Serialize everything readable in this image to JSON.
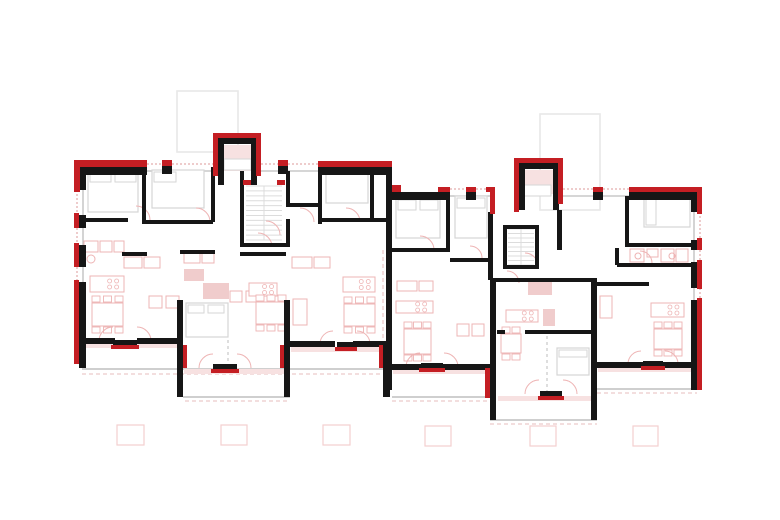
{
  "document": {
    "kind": "architectural-floor-plan",
    "description": "Upper floor plan of two adjoined residential blocks with red-highlighted exterior insulation, entrance vestibules, stair cores and balconies"
  },
  "canvas": {
    "w": 780,
    "h": 520,
    "bg": "#ffffff"
  },
  "palette": {
    "wall_black": "#161616",
    "accent_red": "#c41e23",
    "furniture_pink": "#eeb4b4",
    "fixture_fill": "#f0cccc",
    "band_fill": "#f7e1e1",
    "bed_gray": "#d6d6d6",
    "stair_gray": "#dcdcdc",
    "window_gray": "#bdbdbd",
    "window_red": "#dd9a9a",
    "slab_gray": "#cfcfcf",
    "dash_pink": "#e7bcbc",
    "dash_gray": "#c9c9c9",
    "roof_gray": "#e8e8e8",
    "planter_pink": "#f3cfcf"
  },
  "plan": {
    "roofs": [
      [
        177,
        91,
        61,
        61
      ],
      [
        540,
        114,
        60,
        96
      ]
    ],
    "slab_lines": [
      [
        82,
        369,
        390,
        369
      ],
      [
        183,
        397,
        290,
        397
      ],
      [
        392,
        397,
        490,
        397
      ],
      [
        490,
        420,
        597,
        420
      ],
      [
        597,
        389,
        697,
        389
      ]
    ],
    "pink_dash": [
      [
        82,
        374,
        390,
        374
      ],
      [
        185,
        401,
        288,
        401
      ],
      [
        392,
        401,
        490,
        401
      ],
      [
        490,
        424,
        597,
        424
      ],
      [
        597,
        393,
        697,
        393
      ],
      [
        383,
        250,
        383,
        338
      ]
    ],
    "gray_dash": [
      [
        228,
        340,
        228,
        366
      ],
      [
        547,
        336,
        547,
        393
      ]
    ],
    "light_bands": [
      [
        84,
        343,
        93,
        5
      ],
      [
        291,
        347,
        92,
        5
      ],
      [
        184,
        369,
        100,
        5
      ],
      [
        393,
        369,
        97,
        5
      ],
      [
        598,
        367,
        93,
        5
      ],
      [
        498,
        396,
        93,
        5
      ],
      [
        220,
        145,
        31,
        26
      ],
      [
        521,
        170,
        32,
        24
      ]
    ],
    "pink_fills": [
      [
        203,
        283,
        26,
        16
      ],
      [
        528,
        282,
        24,
        13
      ],
      [
        543,
        309,
        12,
        17
      ],
      [
        184,
        269,
        20,
        12
      ]
    ],
    "window_gray": [
      [
        147,
        171,
        162,
        171
      ],
      [
        172,
        171,
        213,
        171
      ],
      [
        261,
        171,
        278,
        171
      ],
      [
        288,
        171,
        318,
        171
      ],
      [
        83,
        190,
        83,
        215
      ],
      [
        83,
        228,
        83,
        245
      ],
      [
        83,
        267,
        83,
        282
      ],
      [
        450,
        196,
        466,
        196
      ],
      [
        476,
        196,
        490,
        196
      ],
      [
        563,
        196,
        593,
        196
      ],
      [
        603,
        196,
        629,
        196
      ],
      [
        694,
        212,
        694,
        240
      ],
      [
        694,
        250,
        694,
        262
      ],
      [
        694,
        288,
        694,
        300
      ]
    ],
    "window_red_dash": [
      [
        147,
        164,
        162,
        164
      ],
      [
        172,
        164,
        213,
        164
      ],
      [
        261,
        164,
        278,
        164
      ],
      [
        288,
        164,
        318,
        164
      ],
      [
        77,
        190,
        77,
        215
      ],
      [
        77,
        228,
        77,
        245
      ],
      [
        77,
        267,
        77,
        282
      ],
      [
        450,
        189,
        466,
        189
      ],
      [
        476,
        189,
        490,
        189
      ],
      [
        563,
        189,
        593,
        189
      ],
      [
        603,
        189,
        629,
        189
      ],
      [
        700,
        212,
        700,
        240
      ],
      [
        700,
        250,
        700,
        262
      ],
      [
        700,
        288,
        700,
        300
      ]
    ],
    "furniture": [
      [
        124,
        257,
        18,
        11
      ],
      [
        144,
        257,
        16,
        11
      ],
      [
        292,
        257,
        20,
        11
      ],
      [
        314,
        257,
        16,
        11
      ],
      [
        397,
        281,
        20,
        10
      ],
      [
        419,
        281,
        14,
        10
      ],
      [
        630,
        249,
        14,
        13
      ],
      [
        647,
        249,
        11,
        8
      ],
      [
        661,
        249,
        13,
        13
      ],
      [
        676,
        249,
        12,
        13
      ],
      [
        184,
        253,
        16,
        10
      ],
      [
        202,
        253,
        12,
        10
      ],
      [
        84,
        241,
        14,
        11
      ],
      [
        100,
        241,
        12,
        11
      ],
      [
        114,
        241,
        10,
        11
      ],
      [
        149,
        296,
        13,
        12
      ],
      [
        166,
        296,
        13,
        12
      ],
      [
        230,
        291,
        12,
        11
      ],
      [
        246,
        291,
        12,
        11
      ],
      [
        457,
        324,
        12,
        12
      ],
      [
        472,
        324,
        12,
        12
      ],
      [
        293,
        299,
        14,
        26
      ],
      [
        600,
        296,
        12,
        22
      ]
    ],
    "islands": [
      [
        90,
        276,
        34,
        16
      ],
      [
        249,
        283,
        28,
        13
      ],
      [
        343,
        277,
        32,
        15
      ],
      [
        396,
        301,
        37,
        12
      ],
      [
        506,
        310,
        32,
        12
      ],
      [
        651,
        303,
        33,
        14
      ]
    ],
    "tables": [
      [
        92,
        303,
        31,
        23,
        6
      ],
      [
        256,
        302,
        30,
        22,
        6
      ],
      [
        344,
        304,
        31,
        22,
        6
      ],
      [
        404,
        329,
        27,
        25,
        6
      ],
      [
        501,
        334,
        20,
        19,
        4
      ],
      [
        654,
        329,
        28,
        20,
        6
      ]
    ],
    "beds": [
      [
        88,
        170,
        50,
        42
      ],
      [
        152,
        170,
        52,
        38
      ],
      [
        326,
        171,
        42,
        32
      ],
      [
        396,
        198,
        44,
        40
      ],
      [
        455,
        196,
        32,
        42
      ],
      [
        644,
        197,
        46,
        30
      ],
      [
        186,
        303,
        42,
        34
      ],
      [
        557,
        348,
        32,
        27
      ]
    ],
    "gray_rects": [
      [
        224,
        159,
        27,
        11
      ],
      [
        523,
        185,
        28,
        11
      ],
      [
        90,
        172,
        21,
        10
      ],
      [
        115,
        172,
        21,
        10
      ],
      [
        154,
        172,
        22,
        10
      ],
      [
        398,
        200,
        18,
        10
      ],
      [
        420,
        200,
        18,
        10
      ],
      [
        646,
        199,
        10,
        26
      ],
      [
        457,
        198,
        28,
        10
      ],
      [
        188,
        305,
        16,
        8
      ],
      [
        208,
        305,
        16,
        8
      ],
      [
        559,
        350,
        28,
        7
      ]
    ],
    "circles": [
      [
        91,
        259,
        4
      ],
      [
        638,
        256,
        3
      ],
      [
        672,
        256,
        3
      ]
    ],
    "stairs": [
      [
        246,
        186,
        36,
        54,
        11
      ],
      [
        508,
        229,
        26,
        36,
        8
      ]
    ],
    "arcs": [
      "M 99,341 A 14 14 0 0 1 113,327",
      "M 137,327 A 14 14 0 0 1 151,341",
      "M 199,368 A 14 14 0 0 1 213,354",
      "M 237,354 A 14 14 0 0 1 251,368",
      "M 320,344 A 13 13 0 0 1 333,331",
      "M 357,331 A 13 13 0 0 1 370,344",
      "M 406,367 A 14 14 0 0 1 420,353",
      "M 444,353 A 14 14 0 0 1 458,367",
      "M 525,394 A 14 14 0 0 1 539,380",
      "M 563,380 A 14 14 0 0 1 577,394",
      "M 628,364 A 13 13 0 0 1 641,351",
      "M 665,351 A 13 13 0 0 1 678,364",
      "M 136,206 A 14 14 0 0 1 150,220",
      "M 196,208 A 14 14 0 0 1 210,222",
      "M 258,233 A 14 14 0 0 1 272,247",
      "M 300,208 A 14 14 0 0 1 314,222",
      "M 346,208 A 14 14 0 0 1 360,222",
      "M 420,236 A 14 14 0 0 1 434,250",
      "M 470,246 A 12 12 0 0 1 482,258",
      "M 525,253 A 13 13 0 0 1 538,266",
      "M 640,251 A 12 12 0 0 1 652,263",
      "M 507,271 A 12 12 0 0 1 519,283",
      "M 266,221 A 14 14 0 0 1 280,235"
    ],
    "walls_black": [
      [
        80,
        167,
        67,
        8
      ],
      [
        79,
        163,
        7,
        27
      ],
      [
        162,
        166,
        10,
        8
      ],
      [
        278,
        166,
        10,
        8
      ],
      [
        318,
        167,
        74,
        8
      ],
      [
        386,
        163,
        6,
        227
      ],
      [
        79,
        215,
        7,
        13
      ],
      [
        79,
        245,
        7,
        22
      ],
      [
        79,
        282,
        7,
        86
      ],
      [
        83,
        338,
        32,
        6
      ],
      [
        137,
        338,
        46,
        6
      ],
      [
        177,
        300,
        6,
        97
      ],
      [
        284,
        300,
        6,
        97
      ],
      [
        290,
        341,
        45,
        6
      ],
      [
        353,
        341,
        30,
        6
      ],
      [
        383,
        341,
        7,
        56
      ],
      [
        218,
        138,
        6,
        47
      ],
      [
        218,
        138,
        39,
        6
      ],
      [
        251,
        138,
        6,
        47
      ],
      [
        113,
        340,
        24,
        5
      ],
      [
        213,
        364,
        24,
        5
      ],
      [
        337,
        342,
        18,
        5
      ],
      [
        142,
        167,
        4,
        55
      ],
      [
        211,
        167,
        4,
        55
      ],
      [
        80,
        218,
        48,
        4
      ],
      [
        142,
        220,
        71,
        4
      ],
      [
        240,
        171,
        4,
        76
      ],
      [
        286,
        171,
        4,
        34
      ],
      [
        286,
        219,
        4,
        28
      ],
      [
        240,
        243,
        50,
        4
      ],
      [
        318,
        167,
        4,
        57
      ],
      [
        322,
        218,
        64,
        4
      ],
      [
        286,
        203,
        34,
        4
      ],
      [
        370,
        167,
        4,
        53
      ],
      [
        122,
        252,
        25,
        4
      ],
      [
        180,
        250,
        35,
        4
      ],
      [
        240,
        252,
        46,
        4
      ],
      [
        392,
        192,
        58,
        8
      ],
      [
        466,
        192,
        10,
        8
      ],
      [
        490,
        192,
        5,
        20
      ],
      [
        519,
        163,
        6,
        47
      ],
      [
        519,
        163,
        40,
        6
      ],
      [
        553,
        163,
        6,
        47
      ],
      [
        593,
        192,
        10,
        8
      ],
      [
        629,
        192,
        68,
        8
      ],
      [
        691,
        192,
        6,
        20
      ],
      [
        691,
        240,
        6,
        10
      ],
      [
        691,
        262,
        6,
        26
      ],
      [
        691,
        300,
        6,
        90
      ],
      [
        597,
        362,
        46,
        6
      ],
      [
        663,
        362,
        28,
        6
      ],
      [
        392,
        364,
        29,
        6
      ],
      [
        443,
        364,
        47,
        6
      ],
      [
        490,
        278,
        6,
        142
      ],
      [
        591,
        278,
        6,
        142
      ],
      [
        490,
        278,
        107,
        4
      ],
      [
        421,
        363,
        22,
        5
      ],
      [
        540,
        391,
        22,
        5
      ],
      [
        643,
        361,
        20,
        5
      ],
      [
        446,
        196,
        4,
        54
      ],
      [
        488,
        212,
        5,
        68
      ],
      [
        557,
        210,
        5,
        40
      ],
      [
        503,
        225,
        4,
        44
      ],
      [
        535,
        225,
        4,
        44
      ],
      [
        505,
        225,
        32,
        4
      ],
      [
        505,
        265,
        32,
        4
      ],
      [
        392,
        248,
        58,
        4
      ],
      [
        450,
        258,
        42,
        4
      ],
      [
        625,
        196,
        4,
        51
      ],
      [
        627,
        243,
        66,
        4
      ],
      [
        617,
        263,
        76,
        4
      ],
      [
        615,
        248,
        4,
        17
      ],
      [
        597,
        282,
        52,
        4
      ],
      [
        497,
        330,
        8,
        4
      ],
      [
        525,
        330,
        68,
        4
      ]
    ],
    "walls_red": [
      [
        74,
        160,
        73,
        7
      ],
      [
        74,
        160,
        6,
        32
      ],
      [
        74,
        213,
        5,
        15
      ],
      [
        74,
        243,
        5,
        24
      ],
      [
        74,
        280,
        5,
        84
      ],
      [
        162,
        160,
        10,
        6
      ],
      [
        278,
        160,
        10,
        6
      ],
      [
        318,
        161,
        74,
        6
      ],
      [
        392,
        185,
        9,
        7
      ],
      [
        213,
        133,
        5,
        43
      ],
      [
        213,
        133,
        48,
        5
      ],
      [
        256,
        133,
        5,
        43
      ],
      [
        111,
        345,
        28,
        4
      ],
      [
        211,
        369,
        28,
        4
      ],
      [
        335,
        347,
        22,
        4
      ],
      [
        183,
        345,
        4,
        23
      ],
      [
        280,
        345,
        4,
        23
      ],
      [
        379,
        345,
        4,
        23
      ],
      [
        243,
        180,
        8,
        5
      ],
      [
        277,
        180,
        8,
        5
      ],
      [
        514,
        158,
        5,
        54
      ],
      [
        514,
        158,
        49,
        5
      ],
      [
        558,
        158,
        5,
        46
      ],
      [
        486,
        187,
        9,
        5
      ],
      [
        490,
        187,
        5,
        27
      ],
      [
        593,
        187,
        10,
        5
      ],
      [
        629,
        187,
        73,
        5
      ],
      [
        438,
        187,
        12,
        5
      ],
      [
        466,
        187,
        10,
        5
      ],
      [
        697,
        187,
        5,
        27
      ],
      [
        697,
        238,
        5,
        12
      ],
      [
        697,
        260,
        5,
        29
      ],
      [
        697,
        298,
        5,
        92
      ],
      [
        419,
        368,
        26,
        4
      ],
      [
        538,
        396,
        26,
        4
      ],
      [
        641,
        366,
        24,
        4
      ],
      [
        485,
        368,
        5,
        30
      ]
    ],
    "planters": [
      [
        117,
        425,
        27,
        20
      ],
      [
        221,
        425,
        26,
        20
      ],
      [
        323,
        425,
        27,
        20
      ],
      [
        425,
        426,
        26,
        20
      ],
      [
        530,
        426,
        26,
        20
      ],
      [
        633,
        426,
        25,
        20
      ]
    ]
  }
}
